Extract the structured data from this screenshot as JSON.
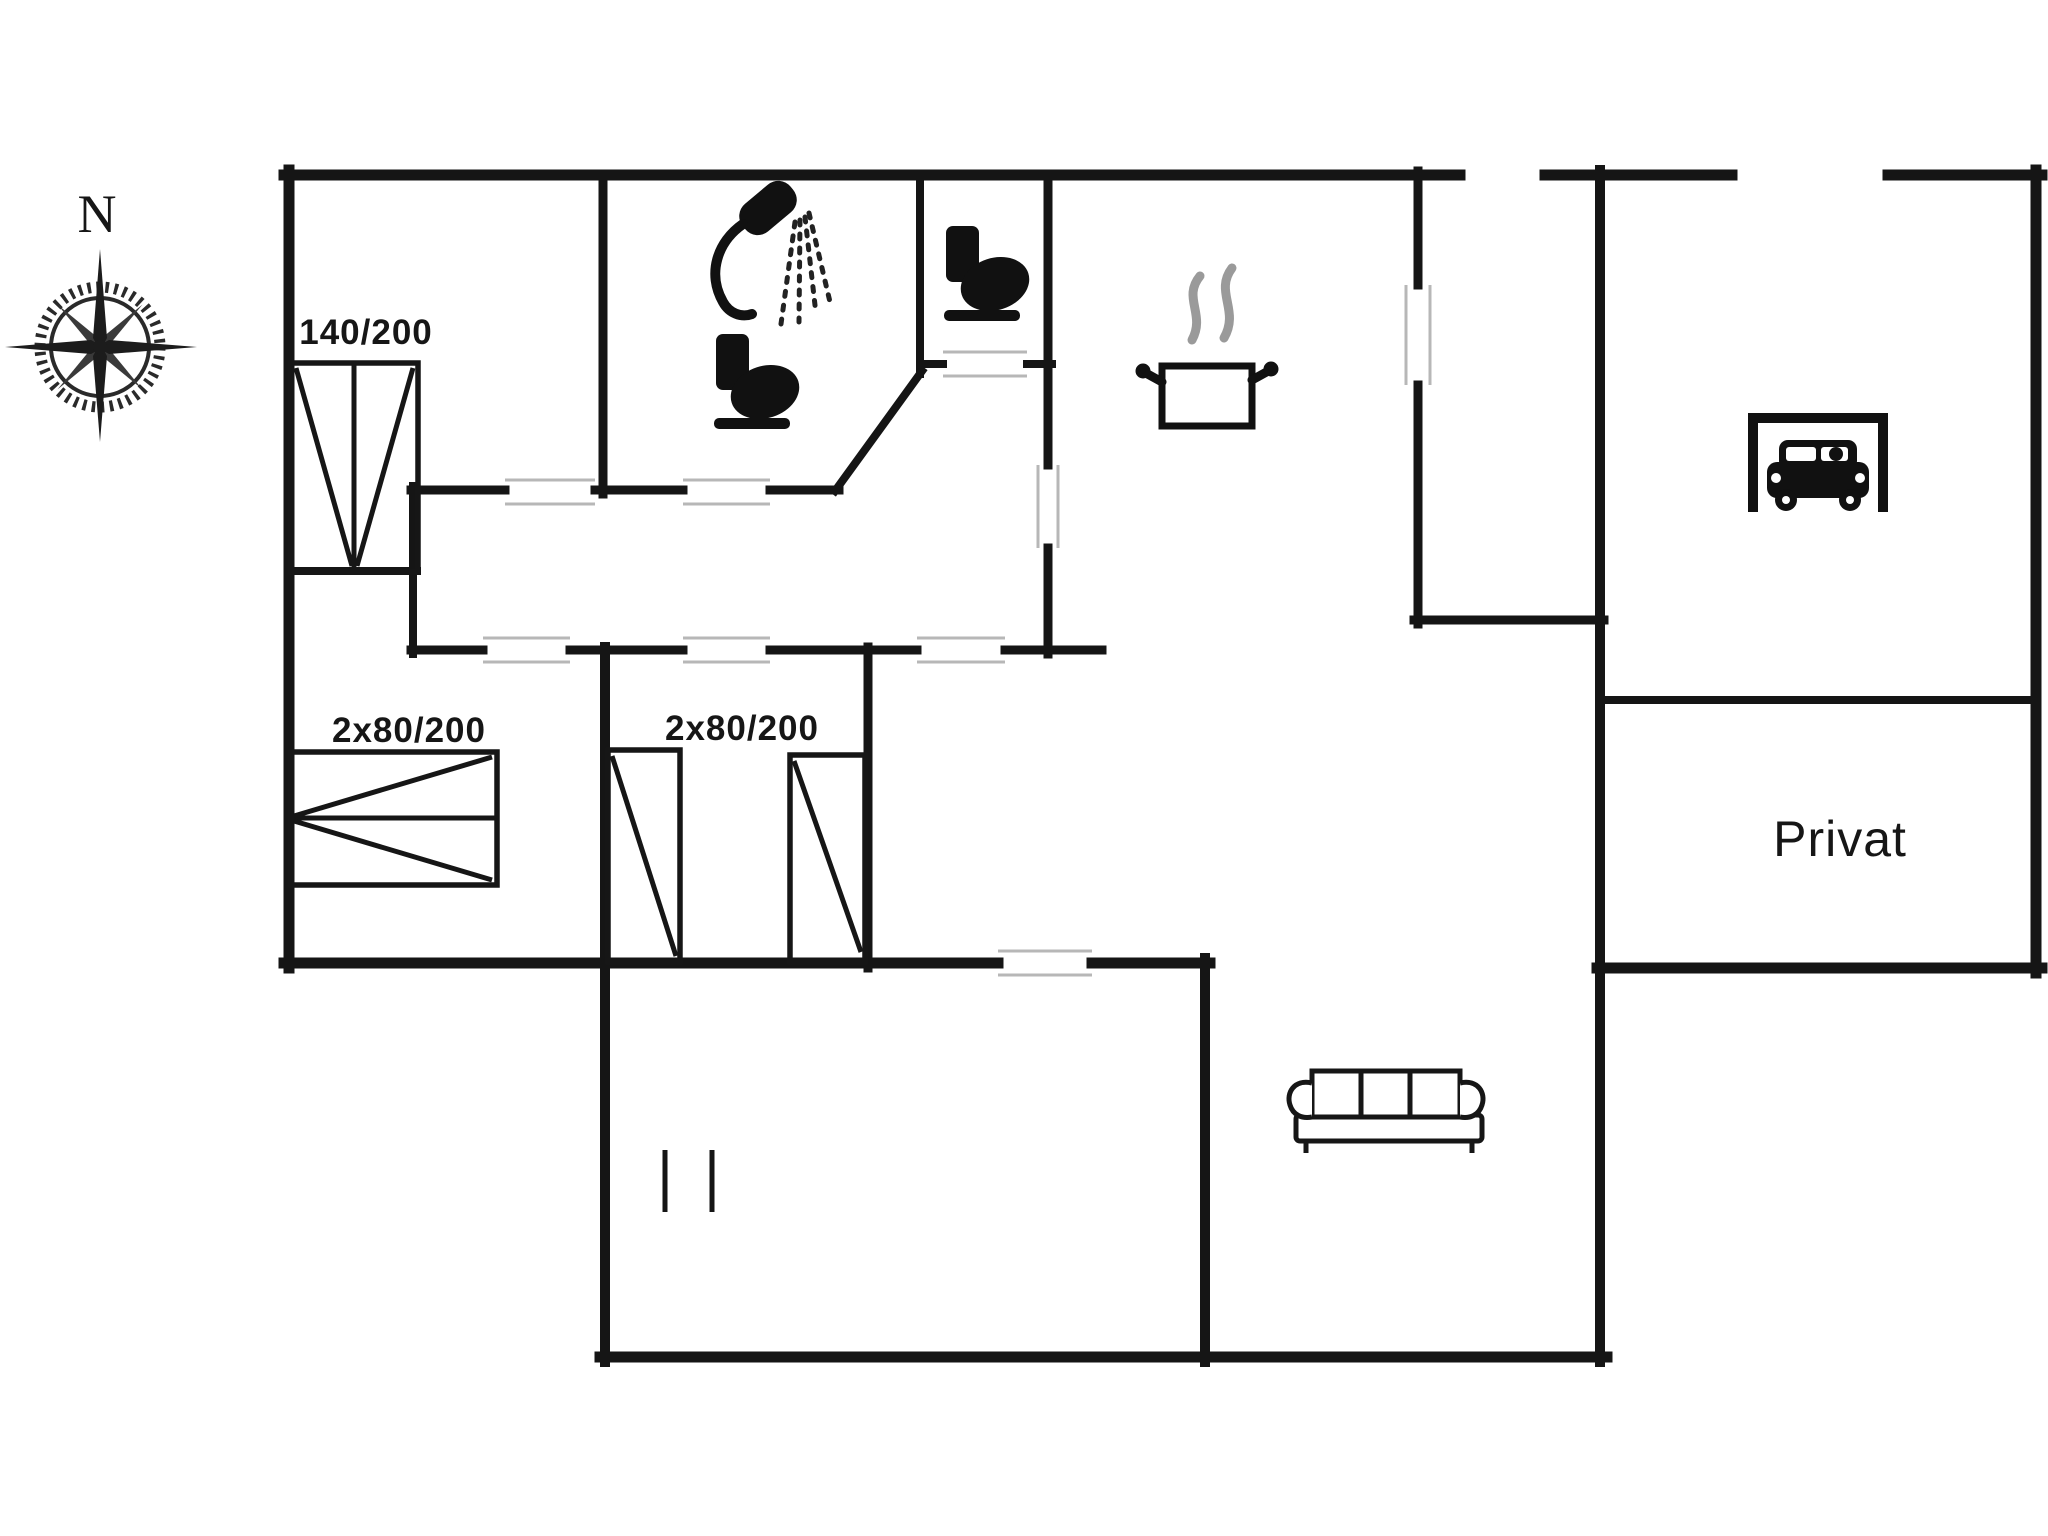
{
  "title": "Holiday home floor plan",
  "compass": {
    "label": "N"
  },
  "labels": {
    "bed_double": "140/200",
    "bed_bunk_left": "2x80/200",
    "bed_twin_mid": "2x80/200",
    "private_room": "Privat"
  },
  "icons": [
    "compass-rose-icon",
    "shower-icon",
    "toilet-icon-bathroom",
    "toilet-icon-wc",
    "cooking-pot-icon",
    "car-garage-icon",
    "sofa-icon",
    "double-bed-140-200",
    "bunk-beds-2x80-200",
    "twin-beds-2x80-200",
    "step-marks"
  ],
  "plan": {
    "size": [
      2048,
      1536
    ],
    "wall_color": "#151515",
    "door_mark_color": "#b7b7b7",
    "furniture_color": "#161616",
    "walls": [
      [
        289,
        170,
        289,
        968,
        11
      ],
      [
        284,
        175,
        1460,
        175,
        11
      ],
      [
        1545,
        175,
        1732,
        175,
        11
      ],
      [
        1888,
        175,
        2042,
        175,
        11
      ],
      [
        2036,
        170,
        2036,
        973,
        11
      ],
      [
        1597,
        968,
        2042,
        968,
        11
      ],
      [
        284,
        963,
        998,
        963,
        11
      ],
      [
        1092,
        963,
        1210,
        963,
        11
      ],
      [
        600,
        1357,
        1607,
        1357,
        11
      ],
      [
        605,
        647,
        605,
        1362,
        10
      ],
      [
        1205,
        958,
        1205,
        1362,
        10
      ],
      [
        1600,
        170,
        1600,
        1362,
        10
      ],
      [
        868,
        647,
        868,
        968,
        9
      ],
      [
        603,
        175,
        603,
        494,
        9
      ],
      [
        920,
        175,
        920,
        374,
        8
      ],
      [
        835,
        491,
        922,
        371,
        8
      ],
      [
        1048,
        175,
        1048,
        465,
        9
      ],
      [
        1048,
        548,
        1048,
        654,
        9
      ],
      [
        1418,
        171,
        1418,
        285,
        9
      ],
      [
        1418,
        385,
        1418,
        624,
        9
      ],
      [
        1414,
        620,
        1604,
        620,
        9
      ],
      [
        1600,
        700,
        2036,
        700,
        8
      ],
      [
        411,
        490,
        505,
        490,
        9
      ],
      [
        595,
        490,
        683,
        490,
        9
      ],
      [
        770,
        490,
        839,
        490,
        9
      ],
      [
        411,
        650,
        483,
        650,
        9
      ],
      [
        570,
        650,
        683,
        650,
        9
      ],
      [
        770,
        650,
        917,
        650,
        9
      ],
      [
        1005,
        650,
        1102,
        650,
        9
      ],
      [
        413,
        486,
        413,
        654,
        8
      ],
      [
        289,
        571,
        417,
        571,
        8
      ],
      [
        920,
        364,
        943,
        364,
        8
      ],
      [
        1027,
        364,
        1052,
        364,
        8
      ]
    ],
    "door_marks": [
      [
        505,
        480,
        595,
        480
      ],
      [
        505,
        504,
        595,
        504
      ],
      [
        683,
        480,
        770,
        480
      ],
      [
        683,
        504,
        770,
        504
      ],
      [
        943,
        352,
        1027,
        352
      ],
      [
        943,
        376,
        1027,
        376
      ],
      [
        483,
        638,
        570,
        638
      ],
      [
        483,
        662,
        570,
        662
      ],
      [
        683,
        638,
        770,
        638
      ],
      [
        683,
        662,
        770,
        662
      ],
      [
        917,
        638,
        1005,
        638
      ],
      [
        917,
        662,
        1005,
        662
      ],
      [
        998,
        951,
        1092,
        951
      ],
      [
        998,
        975,
        1092,
        975
      ],
      [
        1406,
        285,
        1406,
        385
      ],
      [
        1430,
        285,
        1430,
        385
      ],
      [
        1038,
        465,
        1038,
        548
      ],
      [
        1058,
        465,
        1058,
        548
      ]
    ],
    "steps": [
      [
        665,
        1150,
        665,
        1212
      ],
      [
        712,
        1150,
        712,
        1212
      ]
    ],
    "furniture_rects": [
      [
        291,
        363,
        127,
        209
      ],
      [
        291,
        752,
        206,
        133
      ],
      [
        608,
        750,
        72,
        212
      ],
      [
        790,
        755,
        75,
        207
      ]
    ],
    "furniture_lines": [
      [
        354,
        365,
        354,
        570
      ],
      [
        296,
        368,
        352,
        566
      ],
      [
        413,
        368,
        357,
        566
      ],
      [
        291,
        818,
        497,
        818
      ],
      [
        492,
        757,
        294,
        816
      ],
      [
        294,
        821,
        492,
        880
      ],
      [
        612,
        756,
        676,
        956
      ],
      [
        794,
        761,
        861,
        952
      ]
    ]
  }
}
